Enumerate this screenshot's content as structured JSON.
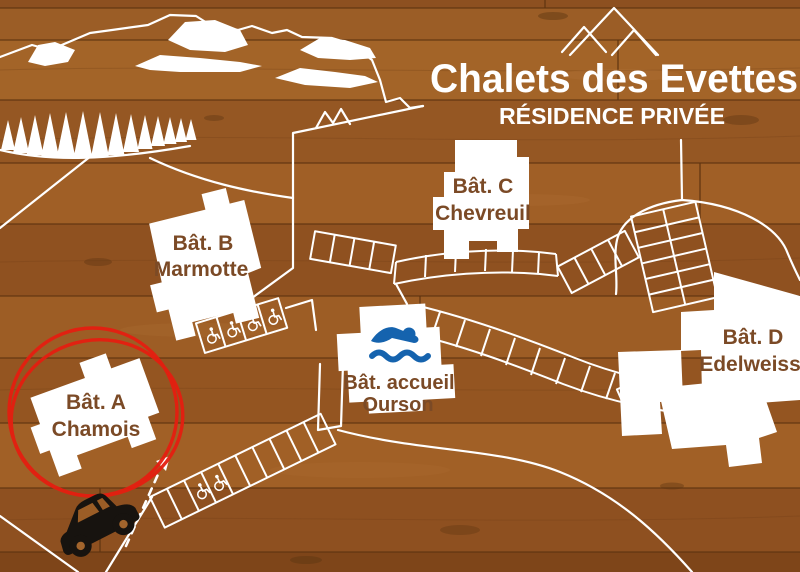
{
  "header": {
    "title": "Chalets des Evettes",
    "subtitle": "RÉSIDENCE PRIVÉE"
  },
  "buildings": {
    "a": {
      "name": "Bât. A",
      "label": "Chamois"
    },
    "b": {
      "name": "Bât. B",
      "label": "Marmotte"
    },
    "c": {
      "name": "Bât. C",
      "label": "Chevreuil"
    },
    "d": {
      "name": "Bât. D",
      "label": "Edelweiss"
    },
    "accueil": {
      "name": "Bât. accueil",
      "label": "Ourson"
    }
  },
  "icons": {
    "pool": "swimmer-icon",
    "accessible_parking": "wheelchair-icon",
    "car": "car-icon",
    "mountain_logo": "mountain-peaks-icon",
    "forest": "pine-trees",
    "highlight": "red-circle-annotation",
    "entrance": "dashed-arrow-icon"
  },
  "colors": {
    "wood": "#9b5d26",
    "line_white": "#ffffff",
    "label_brown": "#7b4a26",
    "highlight_red": "#e51e10",
    "pool_blue": "#1563ae",
    "car_black": "#17130f"
  }
}
